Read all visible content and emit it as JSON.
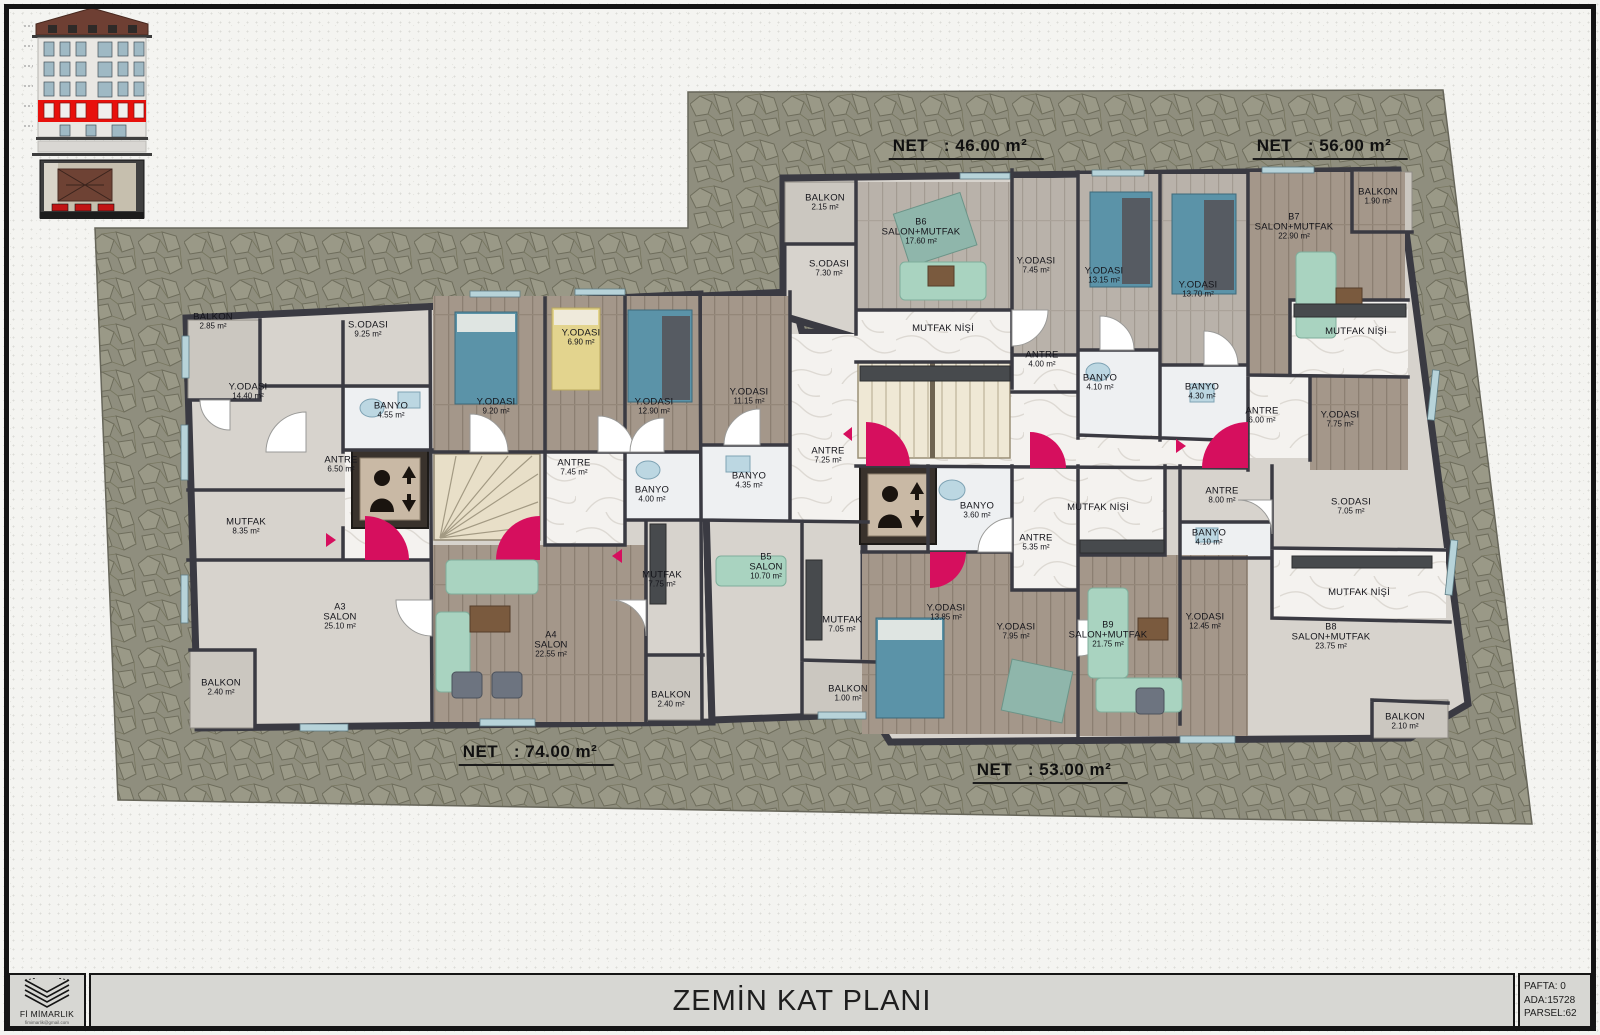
{
  "title_block": {
    "drawing_title": "ZEMİN KAT PLANI",
    "firm_name": "Fİ MİMARLIK",
    "firm_contact": "fimimarlik@gmail.com",
    "pafta": "PAFTA: 0",
    "ada": "ADA:15728",
    "parsel": "PARSEL:62"
  },
  "net_labels": [
    {
      "text": "NET   : 46.00 m²",
      "x": 966,
      "y": 148
    },
    {
      "text": "NET   : 56.00 m²",
      "x": 1330,
      "y": 148
    },
    {
      "text": "NET   : 74.00 m²",
      "x": 536,
      "y": 754
    },
    {
      "text": "NET   : 53.00 m²",
      "x": 1050,
      "y": 772
    }
  ],
  "rooms": [
    {
      "name": "BALKON",
      "area": "2.85 m²",
      "x": 213,
      "y": 322
    },
    {
      "name": "S.ODASI",
      "area": "9.25 m²",
      "x": 368,
      "y": 330
    },
    {
      "name": "Y.ODASI",
      "area": "14.40 m²",
      "x": 248,
      "y": 392
    },
    {
      "name": "BANYO",
      "area": "4.55 m²",
      "x": 391,
      "y": 411
    },
    {
      "name": "ANTRE",
      "area": "6.50 m²",
      "x": 341,
      "y": 465
    },
    {
      "name": "MUTFAK",
      "area": "8.35 m²",
      "x": 246,
      "y": 527
    },
    {
      "unit": "A3",
      "name": "SALON",
      "area": "25.10 m²",
      "x": 340,
      "y": 617
    },
    {
      "name": "BALKON",
      "area": "2.40 m²",
      "x": 221,
      "y": 688
    },
    {
      "name": "Y.ODASI",
      "area": "9.20 m²",
      "x": 496,
      "y": 407
    },
    {
      "name": "Y.ODASI",
      "area": "6.90 m²",
      "x": 581,
      "y": 338
    },
    {
      "name": "Y.ODASI",
      "area": "12.90 m²",
      "x": 654,
      "y": 407
    },
    {
      "name": "ANTRE",
      "area": "7.45 m²",
      "x": 574,
      "y": 468
    },
    {
      "name": "BANYO",
      "area": "4.00 m²",
      "x": 652,
      "y": 495
    },
    {
      "unit": "A4",
      "name": "SALON",
      "area": "22.55 m²",
      "x": 551,
      "y": 645
    },
    {
      "name": "MUTFAK",
      "area": "7.75 m²",
      "x": 662,
      "y": 580
    },
    {
      "name": "BALKON",
      "area": "2.40 m²",
      "x": 671,
      "y": 700
    },
    {
      "name": "Y.ODASI",
      "area": "11.15 m²",
      "x": 749,
      "y": 397
    },
    {
      "name": "BANYO",
      "area": "4.35 m²",
      "x": 749,
      "y": 481
    },
    {
      "name": "ANTRE",
      "area": "7.25 m²",
      "x": 828,
      "y": 456
    },
    {
      "unit": "B5",
      "name": "SALON",
      "area": "10.70 m²",
      "x": 766,
      "y": 567
    },
    {
      "name": "MUTFAK",
      "area": "7.05 m²",
      "x": 842,
      "y": 625
    },
    {
      "name": "BALKON",
      "area": "1.00 m²",
      "x": 848,
      "y": 694
    },
    {
      "name": "BALKON",
      "area": "2.15 m²",
      "x": 825,
      "y": 203
    },
    {
      "name": "S.ODASI",
      "area": "7.30 m²",
      "x": 829,
      "y": 269
    },
    {
      "unit": "B6",
      "name": "SALON+MUTFAK",
      "area": "17.60 m²",
      "x": 921,
      "y": 232
    },
    {
      "name": "Y.ODASI",
      "area": "7.45 m²",
      "x": 1036,
      "y": 266
    },
    {
      "name": "MUTFAK NİŞİ",
      "area": "",
      "x": 943,
      "y": 329
    },
    {
      "name": "ANTRE",
      "area": "4.00 m²",
      "x": 1042,
      "y": 360
    },
    {
      "name": "Y.ODASI",
      "area": "13.15 m²",
      "x": 1104,
      "y": 276
    },
    {
      "name": "Y.ODASI",
      "area": "13.70 m²",
      "x": 1198,
      "y": 290
    },
    {
      "unit": "B7",
      "name": "SALON+MUTFAK",
      "area": "22.90 m²",
      "x": 1294,
      "y": 227
    },
    {
      "name": "BALKON",
      "area": "1.90 m²",
      "x": 1378,
      "y": 197
    },
    {
      "name": "BANYO",
      "area": "4.10 m²",
      "x": 1100,
      "y": 383
    },
    {
      "name": "BANYO",
      "area": "4.30 m²",
      "x": 1202,
      "y": 392
    },
    {
      "name": "ANTRE",
      "area": "6.00 m²",
      "x": 1262,
      "y": 416
    },
    {
      "name": "Y.ODASI",
      "area": "7.75 m²",
      "x": 1340,
      "y": 420
    },
    {
      "name": "MUTFAK NİŞİ",
      "area": "",
      "x": 1356,
      "y": 332
    },
    {
      "name": "BANYO",
      "area": "3.60 m²",
      "x": 977,
      "y": 511
    },
    {
      "name": "ANTRE",
      "area": "5.35 m²",
      "x": 1036,
      "y": 543
    },
    {
      "name": "MUTFAK NİŞİ",
      "area": "",
      "x": 1098,
      "y": 508
    },
    {
      "name": "Y.ODASI",
      "area": "13.85 m²",
      "x": 946,
      "y": 613
    },
    {
      "name": "Y.ODASI",
      "area": "7.95 m²",
      "x": 1016,
      "y": 632
    },
    {
      "unit": "B9",
      "name": "SALON+MUTFAK",
      "area": "21.75 m²",
      "x": 1108,
      "y": 635
    },
    {
      "name": "ANTRE",
      "area": "8.00 m²",
      "x": 1222,
      "y": 496
    },
    {
      "name": "S.ODASI",
      "area": "7.05 m²",
      "x": 1351,
      "y": 507
    },
    {
      "name": "BANYO",
      "area": "4.10 m²",
      "x": 1209,
      "y": 538
    },
    {
      "name": "Y.ODASI",
      "area": "12.45 m²",
      "x": 1205,
      "y": 622
    },
    {
      "name": "MUTFAK NİŞİ",
      "area": "",
      "x": 1359,
      "y": 593
    },
    {
      "unit": "B8",
      "name": "SALON+MUTFAK",
      "area": "23.75 m²",
      "x": 1331,
      "y": 637
    },
    {
      "name": "BALKON",
      "area": "2.10 m²",
      "x": 1405,
      "y": 722
    }
  ],
  "colors": {
    "accent_magenta": "#d60f5e",
    "site_stone": "#8f8e7e",
    "wall": "#3a3a42",
    "floor_base": "#d7d3cd",
    "wood": "#a4978a",
    "marble": "#f4f2ef",
    "window_blue": "#b7d3d9",
    "elevation_red_band": "#e8100c",
    "titlebar_fill": "#d7d7d3"
  }
}
